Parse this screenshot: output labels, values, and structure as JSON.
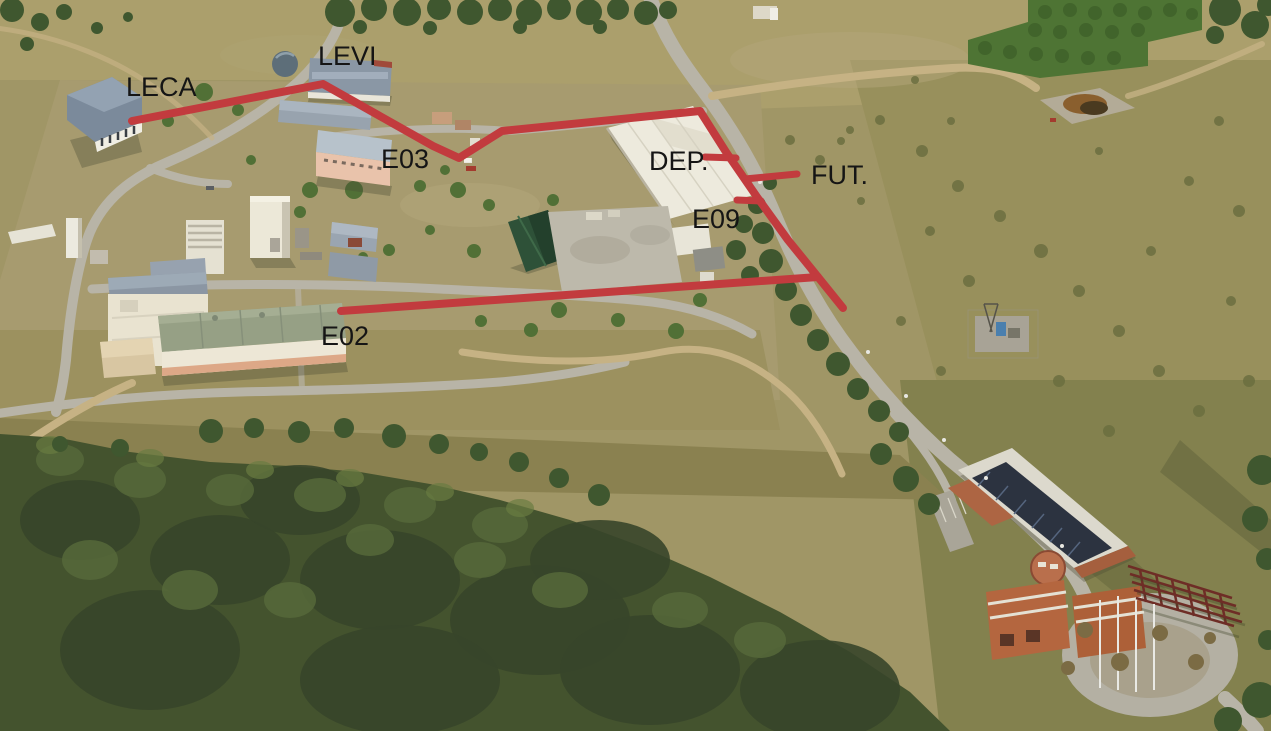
{
  "annotations": {
    "line_color": "#c23b3e",
    "label_color": "#151515",
    "items": [
      {
        "id": "leca",
        "label": "LECA"
      },
      {
        "id": "levi",
        "label": "LEVI"
      },
      {
        "id": "e03",
        "label": "E03"
      },
      {
        "id": "dep",
        "label": "DEP."
      },
      {
        "id": "fut",
        "label": "FUT."
      },
      {
        "id": "e09",
        "label": "E09"
      },
      {
        "id": "e02",
        "label": "E02"
      }
    ]
  }
}
